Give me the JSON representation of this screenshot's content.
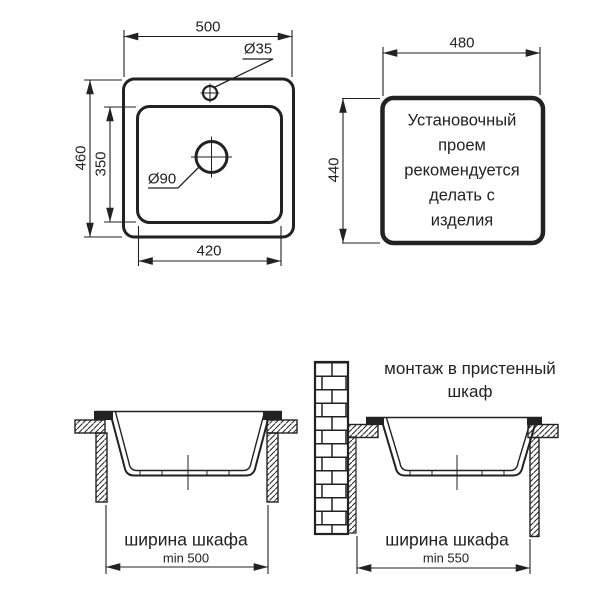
{
  "colors": {
    "ink": "#222222",
    "background": "#ffffff"
  },
  "plan_view": {
    "overall_width": "500",
    "overall_depth": "460",
    "bowl_depth": "350",
    "bowl_width": "420",
    "faucet_hole_diameter": "Ø35",
    "drain_diameter": "Ø90"
  },
  "cutout_view": {
    "cutout_width": "480",
    "cutout_height": "440",
    "note": "Установочный\nпроем\nрекомендуется\nделать с\nизделия"
  },
  "section_view_standard": {
    "cabinet_width_label": "ширина шкафа",
    "cabinet_width_min": "min 500"
  },
  "section_view_wall": {
    "title": "монтаж в пристенный\nшкаф",
    "cabinet_width_label": "ширина шкафа",
    "cabinet_width_min": "min 550"
  }
}
